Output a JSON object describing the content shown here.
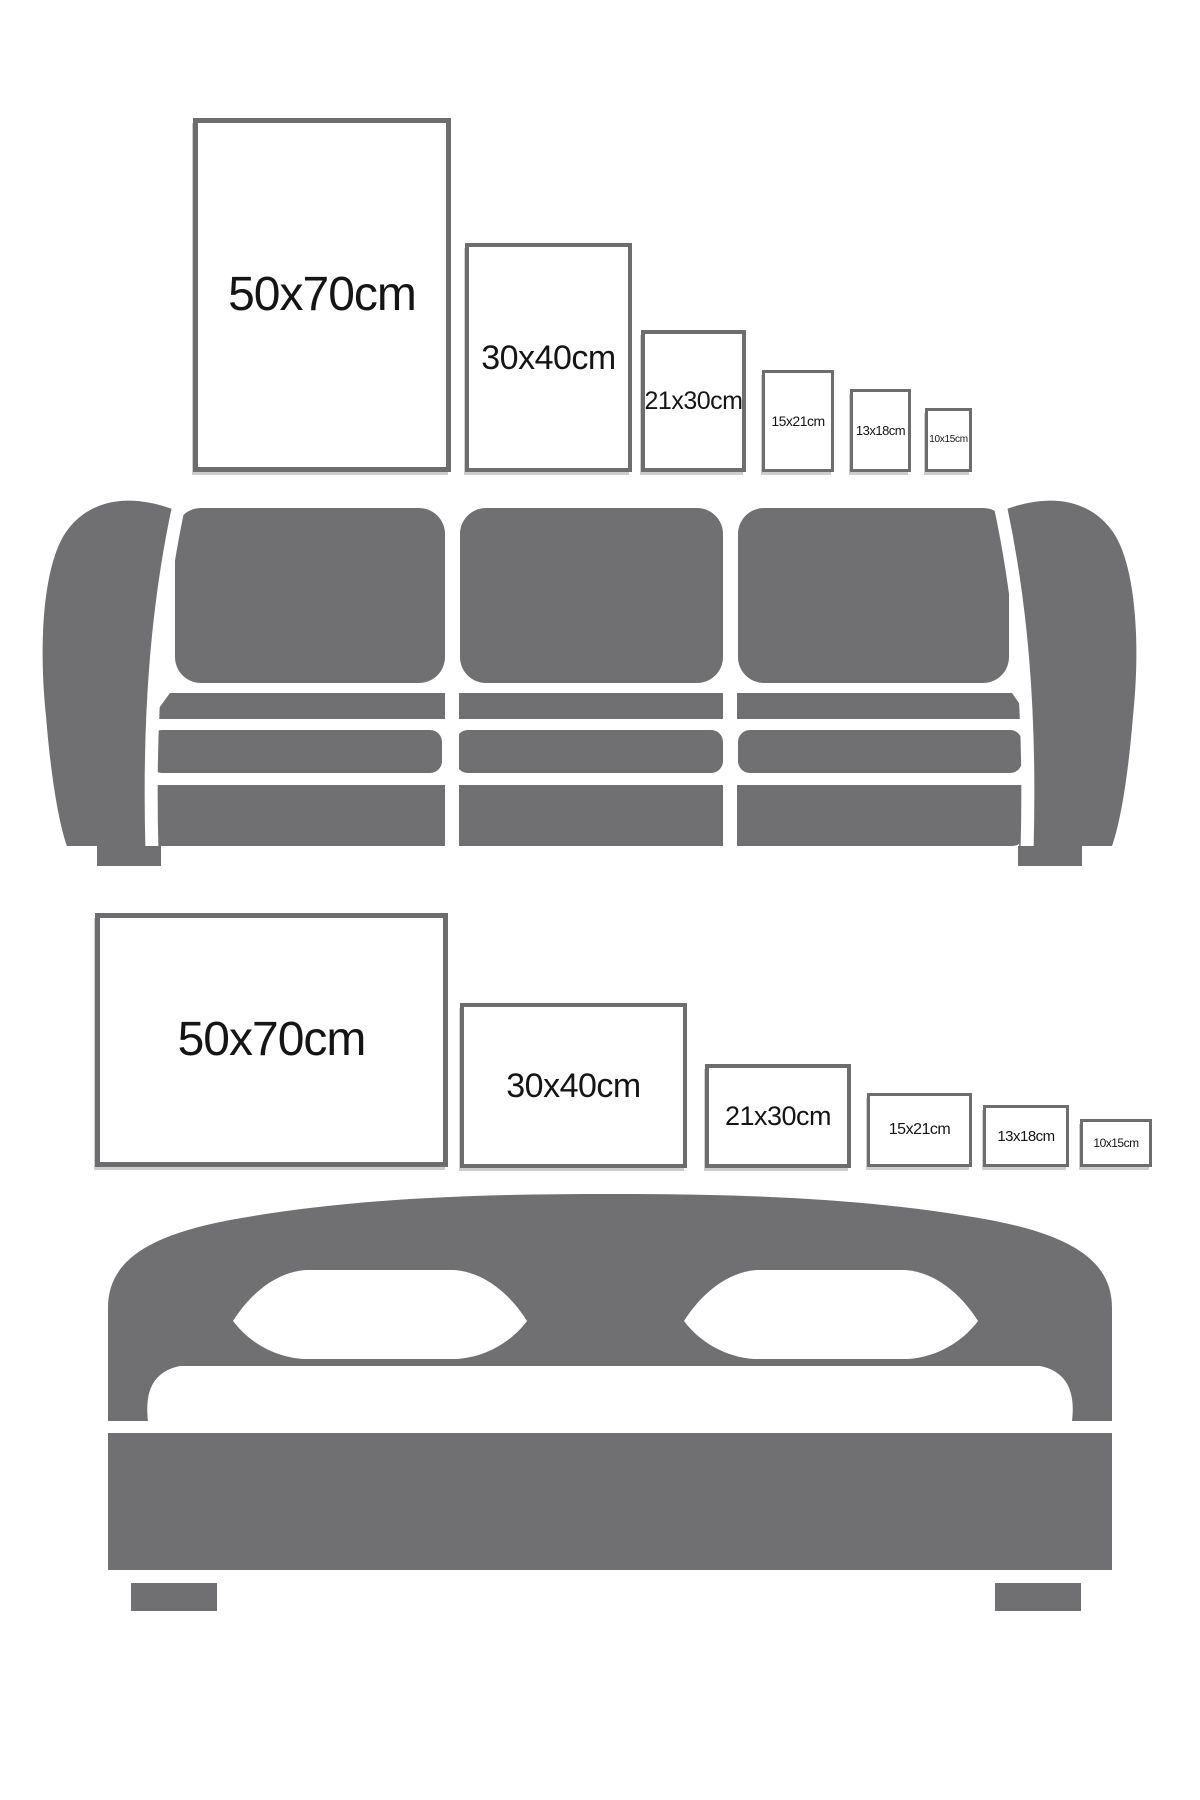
{
  "page": {
    "description": "Poster size comparison guide showing frame sizes above a sofa and above a bed",
    "background": "#ffffff"
  },
  "colors": {
    "furniture_gray": "#707073",
    "frame_border": "#6d6d6f",
    "label_text": "#151515"
  },
  "portrait_row": {
    "orientation": "portrait",
    "frames": [
      {
        "label": "50x70cm"
      },
      {
        "label": "30x40cm"
      },
      {
        "label": "21x30cm"
      },
      {
        "label": "15x21cm"
      },
      {
        "label": "13x18cm"
      },
      {
        "label": "10x15cm"
      }
    ]
  },
  "landscape_row": {
    "orientation": "landscape",
    "frames": [
      {
        "label": "50x70cm"
      },
      {
        "label": "30x40cm"
      },
      {
        "label": "21x30cm"
      },
      {
        "label": "15x21cm"
      },
      {
        "label": "13x18cm"
      },
      {
        "label": "10x15cm"
      }
    ]
  },
  "furniture": [
    {
      "icon": "sofa-silhouette",
      "description": "three-seat sofa, gray silhouette with white seams"
    },
    {
      "icon": "bed-silhouette",
      "description": "double bed with arched headboard and two pillows, gray silhouette"
    }
  ]
}
